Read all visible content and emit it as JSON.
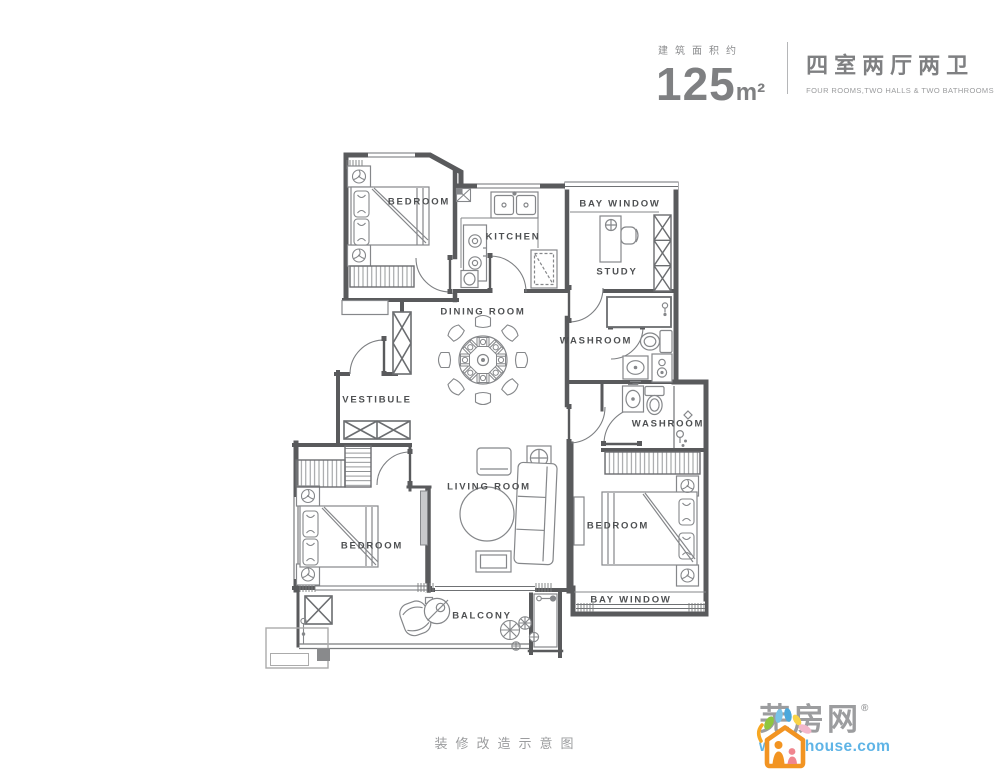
{
  "header": {
    "area_label": "建筑面积约",
    "area_value": "125",
    "area_unit": "m²",
    "title_cn": "四室两厅两卫",
    "title_en": "FOUR ROOMS,TWO HALLS & TWO BATHROOMS"
  },
  "floor_plan": {
    "rooms": [
      {
        "id": "bedroom-top-left",
        "label": "BEDROOM"
      },
      {
        "id": "kitchen",
        "label": "KITCHEN"
      },
      {
        "id": "bay-window-top",
        "label": "BAY WINDOW"
      },
      {
        "id": "study",
        "label": "STUDY"
      },
      {
        "id": "dining-room",
        "label": "DINING ROOM"
      },
      {
        "id": "washroom-1",
        "label": "WASHROOM"
      },
      {
        "id": "vestibule",
        "label": "VESTIBULE"
      },
      {
        "id": "washroom-2",
        "label": "WASHROOM"
      },
      {
        "id": "living-room",
        "label": "LIVING ROOM"
      },
      {
        "id": "bedroom-bottom-left",
        "label": "BEDROOM"
      },
      {
        "id": "bedroom-bottom-right",
        "label": "BEDROOM"
      },
      {
        "id": "bay-window-bottom",
        "label": "BAY WINDOW"
      },
      {
        "id": "balcony",
        "label": "BALCONY"
      }
    ],
    "icon_names": [
      "double-bed-icon",
      "pillow-icon",
      "nightstand-flower-icon",
      "wardrobe-icon",
      "shoe-cabinet-icon",
      "bookshelf-icon",
      "desk-chair-icon",
      "dining-table-icon",
      "dining-chair-icon",
      "sofa-icon",
      "tv-icon",
      "coffee-table-icon",
      "rug-icon",
      "armchair-icon",
      "ac-unit-icon",
      "kitchen-sink-icon",
      "stove-icon",
      "fridge-icon",
      "flue-icon",
      "toilet-icon",
      "vanity-sink-icon",
      "washing-machine-icon",
      "shower-icon",
      "lounge-chair-icon",
      "plant-icon",
      "door-arc",
      "window",
      "wall"
    ]
  },
  "footer": {
    "caption": "装修改造示意图"
  },
  "logo": {
    "brand": "芜房网",
    "registered_mark": "®",
    "website": "wh.ahhouse.com"
  },
  "colors": {
    "wall_line": "#595a5c",
    "furniture_line": "#85878a",
    "label_text": "#4e5052",
    "header_text": "#7f8082",
    "muted_text": "#9b9c9e",
    "logo_gray": "#9c9d9f",
    "logo_blue": "#5fb4e6",
    "logo_orange": "#f29422",
    "logo_green": "#8dc63f",
    "logo_pink": "#f3b8cb",
    "logo_yellow": "#f8d348",
    "logo_skyblue": "#79c3e8"
  }
}
